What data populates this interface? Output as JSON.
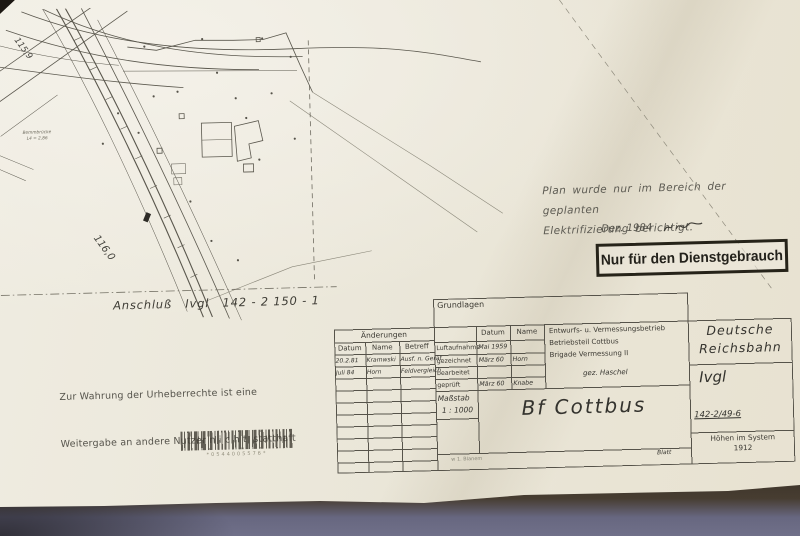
{
  "map": {
    "km_label_1": "115,9",
    "km_label_2": "116,0",
    "bridge_label_1": "Bemmbrücke",
    "bridge_label_2": "L4 = 2,86"
  },
  "notes": {
    "plan_line1": "Plan wurde nur im Bereich der geplanten",
    "plan_line2": "Elektrifizierung berichtigt.",
    "plan_date": "Dez. 1984",
    "stamp": "Nur für den Dienstgebrauch",
    "anschluss": "Anschluß   Ivgl   142 - 2 150 - 1",
    "copyright_line1": "Zur Wahrung der Urheberrechte ist eine",
    "copyright_line2": "Weitergabe an andere Nutzer n i c h t  statthaft",
    "barcode_number": "*0544005576*"
  },
  "titleblock": {
    "grundlagen_label": "Grundlagen",
    "aenderungen": {
      "title": "Änderungen",
      "headers": [
        "Datum",
        "Name",
        "Betreff"
      ],
      "rows": [
        [
          "20.2.81",
          "Kramwski",
          "Ausf. n. Gerät"
        ],
        [
          "Juli 84",
          "Horn",
          "Feldvergleich"
        ]
      ]
    },
    "basis": {
      "headers": [
        "Datum",
        "Name"
      ],
      "rows": [
        {
          "label": "Luftaufnahme",
          "datum": "Mai 1959",
          "name": ""
        },
        {
          "label": "gezeichnet",
          "datum": "März 60",
          "name": "Horn"
        },
        {
          "label": "bearbeitet",
          "datum": "",
          "name": ""
        },
        {
          "label": "geprüft",
          "datum": "März 60",
          "name": "Knabe"
        }
      ]
    },
    "betrieb": {
      "line1": "Entwurfs- u. Vermessungsbetrieb",
      "line2": "Betriebsteil Cottbus",
      "line3": "Brigade Vermessung II",
      "line4": "gez. Haschel"
    },
    "massstab_label": "Maßstab",
    "massstab_value": "1 : 1000",
    "title": "Bf Cottbus",
    "footer_left": "w 1. Blanem",
    "blatt_label": "Blatt",
    "dr_line1": "Deutsche",
    "dr_line2": "Reichsbahn",
    "ivgl": "Ivgl",
    "plan_number": "142-2/49-6",
    "hoehen_line1": "Höhen im System",
    "hoehen_line2": "1912"
  }
}
